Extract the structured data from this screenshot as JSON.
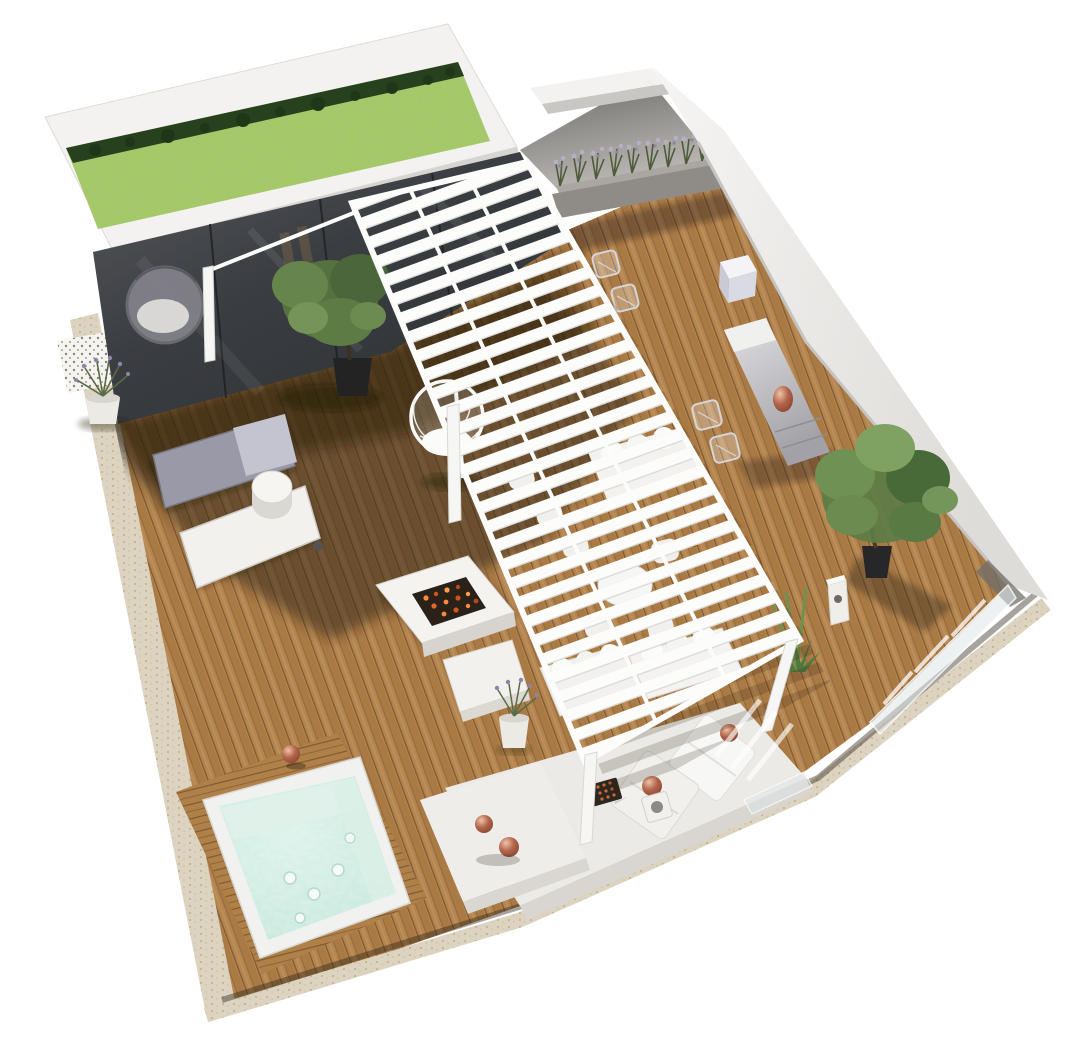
{
  "meta": {
    "type": "3d-architectural-render",
    "subject": "rooftop terrace aerial isometric view",
    "background": "#ffffff"
  },
  "palette": {
    "background": "#ffffff",
    "deck_wood": "#b5854f",
    "deck_wood_alt": "#aa7a45",
    "deck_wood_gap": "#7e5a33",
    "deck_shadow": "rgba(48,32,16,0.52)",
    "grass": "#a3c763",
    "grass_shrubs": "#27401d",
    "glass": "#3a3d41",
    "wall_white": "#f3f2f0",
    "wall_shaded": "#c9c7c4",
    "terrace_floor_dark": "#6e6c6a",
    "terrace_floor_light": "#bdbab6",
    "planter_box": "#8f8c88",
    "pergola_white": "#fcfcfb",
    "water": "#c9eadf",
    "water_seat": "#e0f1ea",
    "tub_rim": "#f1f2f0",
    "travertine": "#dcd3c0",
    "copper": "#b3654a",
    "fire_coals": "#ff8c3a",
    "foliage": "#5d7c45",
    "lavender_bloom": "#9a90b5",
    "furniture_white": "#f2f1ee",
    "lounger_gray": "#9a99a8"
  },
  "scene": {
    "areas": [
      {
        "id": "green-roof",
        "label": "green roof with grass"
      },
      {
        "id": "glass-pavilion",
        "label": "glass pavilion with hanging rattan chair"
      },
      {
        "id": "upper-terrace",
        "label": "gray upper terrace with parapet walls"
      },
      {
        "id": "lavender-planter",
        "label": "long planter with lavender"
      },
      {
        "id": "pergola",
        "label": "white slatted pergola"
      },
      {
        "id": "wood-deck",
        "label": "hardwood deck"
      },
      {
        "id": "hot-tub",
        "label": "square hot tub with jets"
      },
      {
        "id": "sun-loungers",
        "label": "two sun loungers with side table"
      },
      {
        "id": "fire-table",
        "label": "fire pit coffee table"
      },
      {
        "id": "outdoor-kitchen",
        "label": "outdoor kitchen counter with bar stools"
      },
      {
        "id": "olive-tree",
        "label": "potted olive tree"
      },
      {
        "id": "lounge-platform",
        "label": "white daybed platform with pillows"
      },
      {
        "id": "sofas",
        "label": "white outdoor sofas and dining set"
      },
      {
        "id": "glass-railing",
        "label": "glass railing at deck edge"
      },
      {
        "id": "stone-border",
        "label": "travertine stone border"
      }
    ]
  }
}
